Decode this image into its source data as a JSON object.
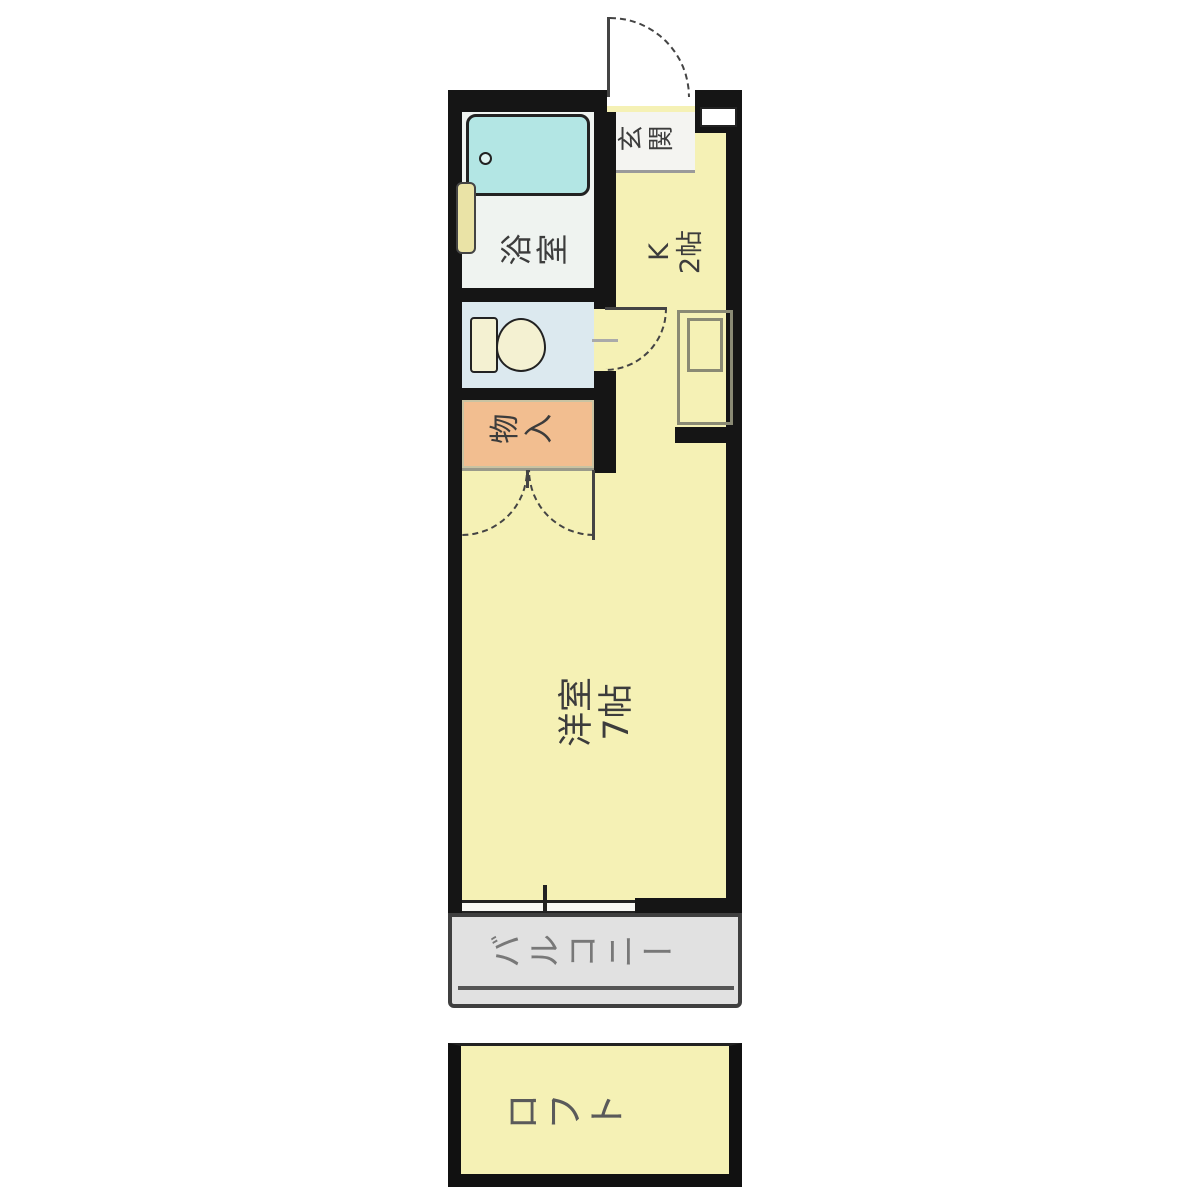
{
  "plan": {
    "type": "japanese-apartment-floor-plan",
    "rooms": {
      "entrance": {
        "label": "玄関"
      },
      "bathroom": {
        "label": "浴室"
      },
      "kitchen": {
        "label_line1": "K",
        "label_line2": "2帖"
      },
      "toilet": {
        "label": ""
      },
      "storage": {
        "label": "物入"
      },
      "main_room": {
        "label_line1": "洋室",
        "label_line2": "7帖"
      },
      "balcony": {
        "label": "バルコニー"
      },
      "loft": {
        "label": "ロフト"
      }
    },
    "icons": {
      "bathtub": "bathtub-icon",
      "bathtub_drain": "drain-icon",
      "toilet": "toilet-icon",
      "kitchen_sink": "kitchen-sink-icon",
      "door_swings": "door-swing-arc-icon",
      "window": "window-icon"
    },
    "colors": {
      "room_yellow": "#F5F1B5",
      "storage_orange": "#F2BE90",
      "toilet_blue": "#DCE9EF",
      "bathroom_floor": "#EFF3F0",
      "entrance_floor": "#F4F4F1",
      "bathtub_cyan": "#B3E6E4",
      "fixture_cream": "#F4F1D2",
      "bath_window_yellow": "#EAE3A6",
      "balcony_gray": "#E1E1E1",
      "wall_black": "#151515",
      "label_gray": "#787878"
    }
  }
}
